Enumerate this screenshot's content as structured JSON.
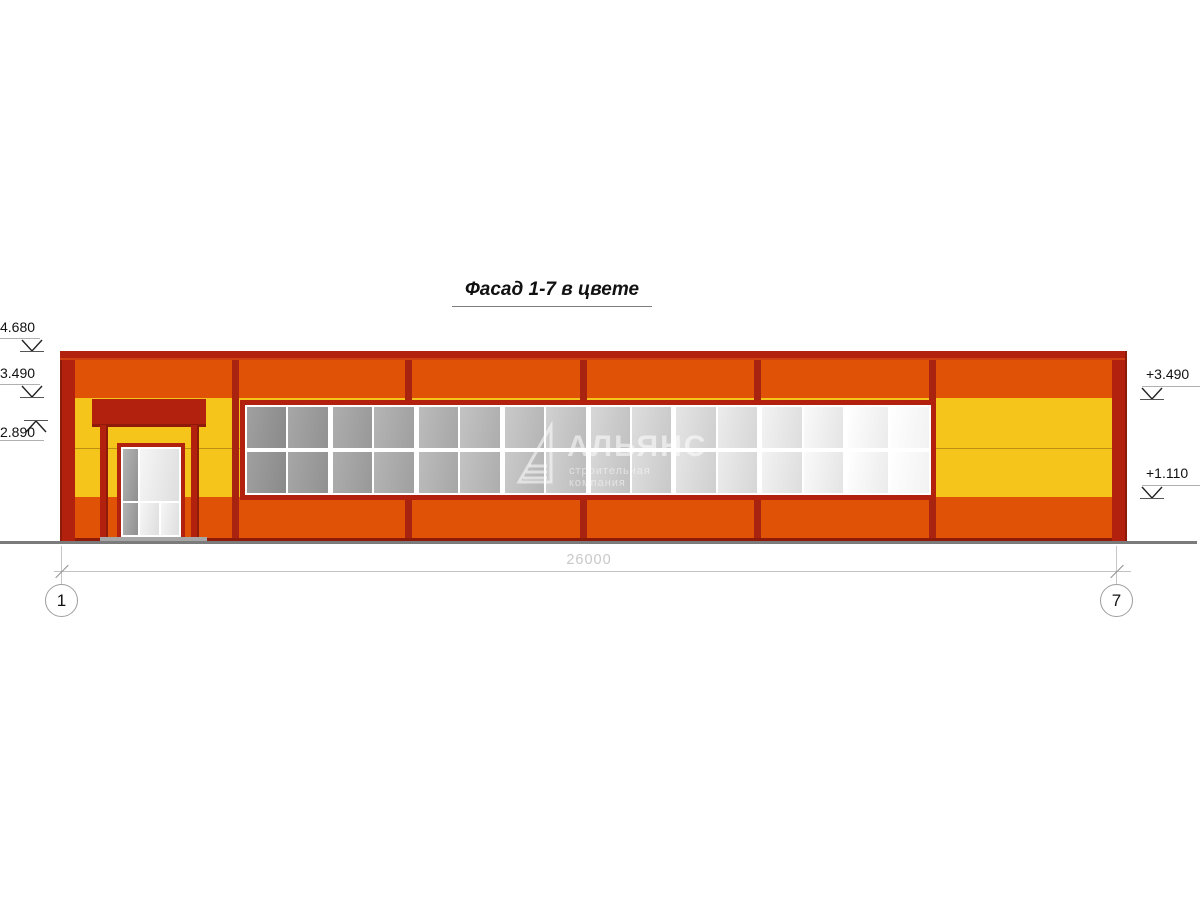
{
  "title": {
    "text": "Фасад 1-7 в цвете"
  },
  "colors": {
    "orange": "#e05206",
    "yellow": "#f6c51b",
    "dark_red": "#b2200e",
    "divider_red": "#a82310",
    "glass_dark": "#8f8f8f",
    "glass_light": "#f8f8f8",
    "ground_gray": "#7b7b7b"
  },
  "elevation_marks": {
    "left": [
      {
        "label": "4.680"
      },
      {
        "label": "3.490"
      },
      {
        "label": "2.890"
      }
    ],
    "right": [
      {
        "label": "+3.490"
      },
      {
        "label": "+1.110"
      }
    ]
  },
  "dimension": {
    "value": "26000"
  },
  "axes": {
    "left": "1",
    "right": "7"
  },
  "watermark": {
    "name": "АЛЬЯНС",
    "subtitle": "строительная компания"
  },
  "window_band": {
    "rows": 2,
    "pairs": 8
  }
}
